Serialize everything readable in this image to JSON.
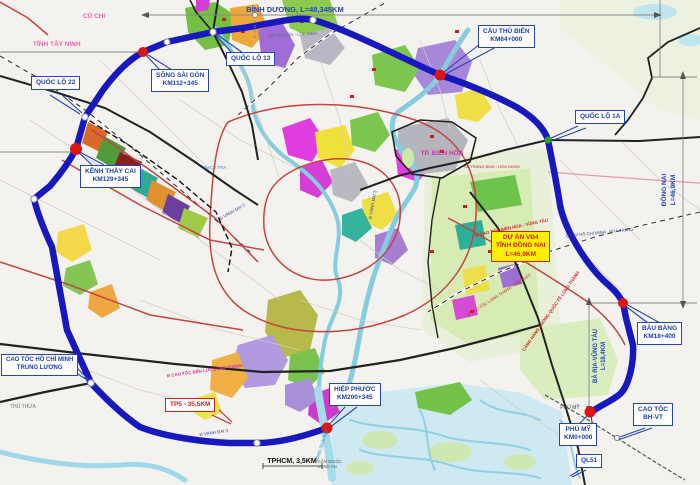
{
  "callouts": {
    "cau_thu_bien": {
      "line1": "CẦU THỦ BIÊN",
      "line2": "KM64+000"
    },
    "quoc_lo_13": {
      "line1": "QUỐC LỘ 13"
    },
    "song_sai_gon": {
      "line1": "SÔNG SÀI GÒN",
      "line2": "KM112+345"
    },
    "quoc_lo_22": {
      "line1": "QUỐC LỘ 22"
    },
    "kenh_thay_cai": {
      "line1": "KÊNH THẦY CAI",
      "line2": "KM129+345"
    },
    "quoc_lo_1a": {
      "line1": "QUỐC LỘ 1A"
    },
    "du_an_vd4": {
      "line1": "DỰ ÁN VĐ4",
      "line2": "TỈNH ĐỒNG NAI",
      "line3": "L=46,9KM"
    },
    "bau_bang": {
      "line1": "BÀU BÀNG",
      "line2": "KM18+400"
    },
    "cao_toc_bhvt": {
      "line1": "CAO TỐC",
      "line2": "BH-VT"
    },
    "phu_my": {
      "line1": "PHÚ MỸ",
      "line2": "KM0+000"
    },
    "ql51": {
      "line1": "QL51"
    },
    "hiep_phuoc": {
      "line1": "HIỆP PHƯỚC",
      "line2": "KM200+345"
    },
    "cao_toc_hcm_trung_luong": {
      "line1": "CAO TỐC HỒ CHÍ MINH",
      "line2": "TRUNG LƯƠNG"
    },
    "tp5": {
      "line1": "TP5 - 35,5KM"
    }
  },
  "dimensions": {
    "binh_duong": "BÌNH DƯƠNG, L=48,345KM",
    "dong_nai_line1": "ĐỒNG NAI",
    "dong_nai_line2": "L=46,9KM",
    "ba_ria_line1": "BÀ RỊA-VŨNG TÀU",
    "ba_ria_line2": "L=18,4KM",
    "tphcm": "TPHCM, 3,5KM"
  },
  "places": {
    "cu_chi": "CỦ CHI",
    "tinh_tay_ninh": "TỈNH TÂY NINH",
    "thu_thua": "THỦ THỪA",
    "tp_bien_hoa": "TP. BIÊN HÒA",
    "phu_my_town": "PHÚ MỸ",
    "can_giuoc": "CẦN GIUỘC",
    "long_an": "LONG AN"
  },
  "roads": {
    "ds_sai_gon_loc_ninh": "ĐS SÀI GÒN - LỘC NINH",
    "ds_hcm_nha_trang": "ĐS TP HỒ CHÍ MINH - NHA TRANG",
    "ct_bien_hoa_vung_tau": "Đ CAO TỐC BIÊN HÒA - VŨNG TÀU",
    "ct_ben_luc_long_thanh": "Đ CAO TỐC BẾN LỨC LONG THÀNH",
    "ct_long_thanh_dau_giay": "Đ CAO TỐC LONG THÀNH - DẦU GIÂY",
    "vanh_dai_3": "Đ VÀNH ĐAI 3",
    "vanh_dai_2": "Đ VÀNH ĐAI 2",
    "rach_tra": "RẠCH TRA",
    "song_soai_rap": "SÔNG SOÀI RẠP",
    "sb_trang_bom": "SB TRẢNG BOM - HÒA HƯNG",
    "cang_hang_khong": "CẢNG HÀNG KHÔNG QUỐC TẾ LONG THÀNH"
  },
  "colors": {
    "ring_road": "#1818bf",
    "marker_red": "#dd1515",
    "marker_green": "#28a828",
    "callout_blue": "#2746b4",
    "project_box_yellow": "#ffef00",
    "alert_red": "#d42020"
  }
}
